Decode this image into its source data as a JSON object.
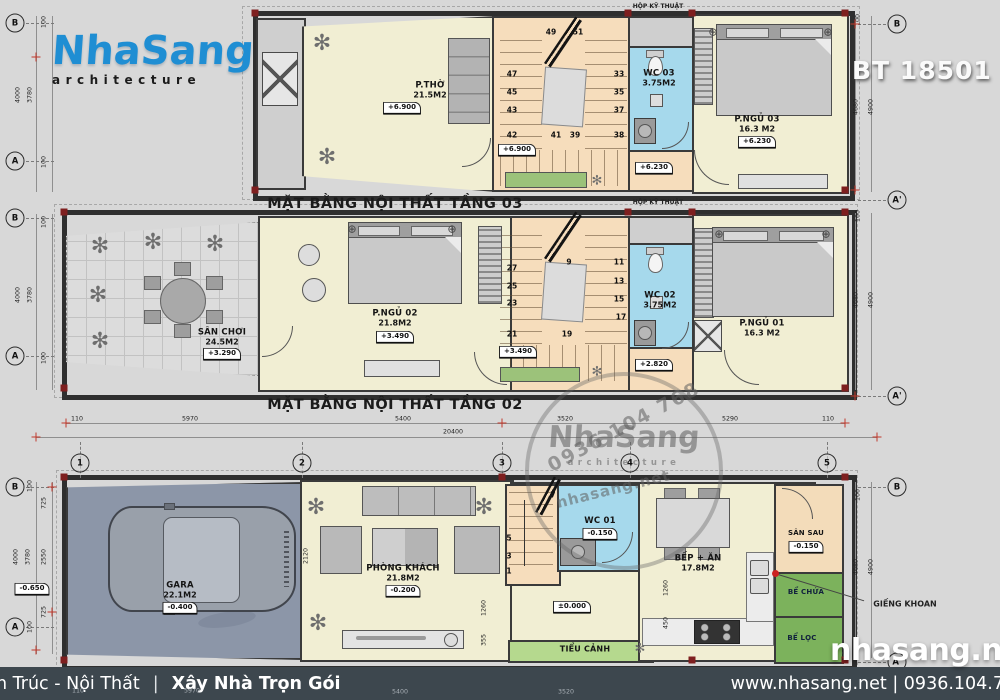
{
  "sheet": {
    "code": "BT 18501"
  },
  "logo": {
    "brand": "NhaSang",
    "sub": "architecture"
  },
  "footer": {
    "left": "n Trúc - Nội Thất",
    "sep": "|",
    "left_bold": "Xây Nhà Trọn Gói",
    "right": "www.nhasang.net | 0936.104.7"
  },
  "stamp": {
    "phone": "0936 104 768",
    "brand": "NhaSang",
    "sub": "architecture",
    "site": "nhasang.net"
  },
  "big_watermark": "nhasang.net",
  "colors": {
    "accent_blue": "#1f8ed3",
    "wall": "#3a3a3a",
    "wc_blue": "#a6d9ec",
    "room_cream": "#f1eed3",
    "stair_tan": "#f6ddbc",
    "tank_green": "#7cb25c",
    "garage_floor": "#8c96a8",
    "footer_bar": "#3d474e",
    "red_mark": "#c0392b"
  },
  "floor3": {
    "title": "MẶT BẰNG NỘI THẤT TẦNG 03",
    "duct": "HỘP KỸ THUẬT",
    "stair_level": "+6.900",
    "hall_level": "+6.230",
    "rooms": {
      "ptho": {
        "name": "P.THỜ",
        "area": "21.5M2",
        "level": "+6.900"
      },
      "wc": {
        "name": "WC 03",
        "area": "3.75M2"
      },
      "bed": {
        "name": "P.NGỦ 03",
        "area": "16.3 M2",
        "level": "+6.230"
      }
    }
  },
  "floor2": {
    "title": "MẶT BẰNG NỘI THẤT TẦNG 02",
    "duct": "HỘP KỸ THUẬT",
    "stair_level": "+3.490",
    "hall_level": "+2.820",
    "rooms": {
      "san_choi": {
        "name": "SÂN CHƠI",
        "area": "24.5M2",
        "level": "+3.290"
      },
      "bed2": {
        "name": "P.NGỦ 02",
        "area": "21.8M2",
        "level": "+3.490"
      },
      "wc": {
        "name": "WC 02",
        "area": "3.75M2"
      },
      "bed1": {
        "name": "P.NGỦ 01",
        "area": "16.3 M2"
      }
    }
  },
  "floor1": {
    "zero_level": "±0.000",
    "outside_level": "-0.650",
    "rooms": {
      "gara": {
        "name": "GARA",
        "area": "22.1M2",
        "level": "-0.400"
      },
      "khach": {
        "name": "PHÒNG KHÁCH",
        "area": "21.8M2",
        "level": "-0.200"
      },
      "wc": {
        "name": "WC 01",
        "level": "-0.150"
      },
      "bep": {
        "name": "BẾP + ĂN",
        "area": "17.8M2"
      },
      "san_sau": {
        "name": "SÂN SAU",
        "level": "-0.150"
      },
      "tieu_canh": {
        "name": "TIỂU CẢNH"
      },
      "be_chua": {
        "name": "BỂ CHỨA"
      },
      "be_loc": {
        "name": "BỂ LỌC"
      },
      "gieng": {
        "name": "GIẾNG KHOAN"
      }
    }
  },
  "icon_glyphs": {
    "plant": "✻",
    "lamp": "⊕"
  },
  "layers": {
    "lines": [
      {
        "c": "hline",
        "x": 66,
        "y": 423,
        "w": 779
      },
      {
        "c": "hline",
        "x": 36,
        "y": 437,
        "w": 841
      },
      {
        "c": "vline",
        "x": 36,
        "y": 16,
        "h": 176
      },
      {
        "c": "vline",
        "x": 52,
        "y": 16,
        "h": 176
      },
      {
        "c": "vline",
        "x": 36,
        "y": 214,
        "h": 176
      },
      {
        "c": "vline",
        "x": 52,
        "y": 214,
        "h": 176
      },
      {
        "c": "vline",
        "x": 36,
        "y": 482,
        "h": 172
      },
      {
        "c": "vline",
        "x": 52,
        "y": 482,
        "h": 172
      },
      {
        "c": "vline",
        "x": 855,
        "y": 16,
        "h": 176
      },
      {
        "c": "vline",
        "x": 871,
        "y": 16,
        "h": 176
      },
      {
        "c": "vline",
        "x": 855,
        "y": 213,
        "h": 177
      },
      {
        "c": "vline",
        "x": 871,
        "y": 213,
        "h": 177
      },
      {
        "c": "vline",
        "x": 855,
        "y": 482,
        "h": 176
      },
      {
        "c": "vline",
        "x": 871,
        "y": 482,
        "h": 176
      },
      {
        "c": "dashv",
        "x": 80,
        "y": 442,
        "h": 36
      },
      {
        "c": "dashv",
        "x": 302,
        "y": 442,
        "h": 36
      },
      {
        "c": "dashv",
        "x": 502,
        "y": 442,
        "h": 36
      },
      {
        "c": "dashv",
        "x": 630,
        "y": 442,
        "h": 36
      },
      {
        "c": "dashv",
        "x": 827,
        "y": 442,
        "h": 36
      },
      {
        "c": "dashh",
        "x": 26,
        "y": 23,
        "w": 28
      },
      {
        "c": "dashh",
        "x": 26,
        "y": 161,
        "w": 28
      },
      {
        "c": "dashh",
        "x": 26,
        "y": 218,
        "w": 28
      },
      {
        "c": "dashh",
        "x": 26,
        "y": 356,
        "w": 28
      },
      {
        "c": "dashh",
        "x": 26,
        "y": 487,
        "w": 28
      },
      {
        "c": "dashh",
        "x": 26,
        "y": 627,
        "w": 28
      },
      {
        "c": "dashh",
        "x": 858,
        "y": 24,
        "w": 28
      },
      {
        "c": "dashh",
        "x": 858,
        "y": 200,
        "w": 28
      },
      {
        "c": "dashh",
        "x": 858,
        "y": 396,
        "w": 28
      },
      {
        "c": "dashh",
        "x": 858,
        "y": 487,
        "w": 28
      },
      {
        "c": "dashh",
        "x": 858,
        "y": 662,
        "w": 28
      }
    ],
    "dims": [
      {
        "t": "110",
        "x": 77,
        "y": 419,
        "c": "dim"
      },
      {
        "t": "5970",
        "x": 190,
        "y": 419,
        "c": "dim"
      },
      {
        "t": "5400",
        "x": 403,
        "y": 419,
        "c": "dim"
      },
      {
        "t": "3520",
        "x": 565,
        "y": 419,
        "c": "dim"
      },
      {
        "t": "5290",
        "x": 730,
        "y": 419,
        "c": "dim"
      },
      {
        "t": "110",
        "x": 828,
        "y": 419,
        "c": "dim"
      },
      {
        "t": "20400",
        "x": 453,
        "y": 432,
        "c": "dim"
      },
      {
        "t": "4000",
        "x": 18,
        "y": 95,
        "r": -90,
        "c": "dim"
      },
      {
        "t": "3780",
        "x": 30,
        "y": 95,
        "r": -90,
        "c": "dim"
      },
      {
        "t": "100",
        "x": 44,
        "y": 22,
        "r": -90,
        "c": "dim"
      },
      {
        "t": "100",
        "x": 44,
        "y": 162,
        "r": -90,
        "c": "dim"
      },
      {
        "t": "4000",
        "x": 18,
        "y": 295,
        "r": -90,
        "c": "dim"
      },
      {
        "t": "3780",
        "x": 30,
        "y": 295,
        "r": -90,
        "c": "dim"
      },
      {
        "t": "100",
        "x": 44,
        "y": 222,
        "r": -90,
        "c": "dim"
      },
      {
        "t": "100",
        "x": 44,
        "y": 358,
        "r": -90,
        "c": "dim"
      },
      {
        "t": "100",
        "x": 30,
        "y": 486,
        "r": -90,
        "c": "dim"
      },
      {
        "t": "725",
        "x": 44,
        "y": 503,
        "r": -90,
        "c": "dim"
      },
      {
        "t": "4000",
        "x": 16,
        "y": 557,
        "r": -90,
        "c": "dim"
      },
      {
        "t": "3780",
        "x": 28,
        "y": 557,
        "r": -90,
        "c": "dim"
      },
      {
        "t": "2550",
        "x": 44,
        "y": 557,
        "r": -90,
        "c": "dim"
      },
      {
        "t": "725",
        "x": 44,
        "y": 612,
        "r": -90,
        "c": "dim"
      },
      {
        "t": "100",
        "x": 30,
        "y": 627,
        "r": -90,
        "c": "dim"
      },
      {
        "t": "100",
        "x": 858,
        "y": 20,
        "r": -90,
        "c": "dim"
      },
      {
        "t": "4680",
        "x": 856,
        "y": 107,
        "r": -90,
        "c": "dim"
      },
      {
        "t": "4900",
        "x": 871,
        "y": 107,
        "r": -90,
        "c": "dim"
      },
      {
        "t": "100",
        "x": 858,
        "y": 216,
        "r": -90,
        "c": "dim"
      },
      {
        "t": "4680",
        "x": 856,
        "y": 300,
        "r": -90,
        "c": "dim"
      },
      {
        "t": "4900",
        "x": 871,
        "y": 300,
        "r": -90,
        "c": "dim"
      },
      {
        "t": "100",
        "x": 858,
        "y": 495,
        "r": -90,
        "c": "dim"
      },
      {
        "t": "4680",
        "x": 856,
        "y": 567,
        "r": -90,
        "c": "dim"
      },
      {
        "t": "4900",
        "x": 871,
        "y": 567,
        "r": -90,
        "c": "dim"
      },
      {
        "t": "100",
        "x": 845,
        "y": 655,
        "r": -90,
        "c": "dim"
      },
      {
        "t": "2120",
        "x": 306,
        "y": 556,
        "r": -90,
        "c": "dim"
      },
      {
        "t": "1260",
        "x": 484,
        "y": 608,
        "r": -90,
        "c": "dim"
      },
      {
        "t": "355",
        "x": 484,
        "y": 640,
        "r": -90,
        "c": "dim"
      },
      {
        "t": "1260",
        "x": 666,
        "y": 588,
        "r": -90,
        "c": "dim"
      },
      {
        "t": "450",
        "x": 666,
        "y": 623,
        "r": -90,
        "c": "dim"
      },
      {
        "t": "110",
        "x": 78,
        "y": 691,
        "c": "faint"
      },
      {
        "t": "5970",
        "x": 192,
        "y": 691,
        "c": "faint"
      },
      {
        "t": "5400",
        "x": 400,
        "y": 692,
        "c": "faint"
      },
      {
        "t": "3520",
        "x": 566,
        "y": 692,
        "c": "faint"
      }
    ],
    "stairs": [
      {
        "t": "49",
        "x": 551,
        "y": 32,
        "c": "step"
      },
      {
        "t": "51",
        "x": 578,
        "y": 32,
        "c": "step"
      },
      {
        "t": "47",
        "x": 512,
        "y": 74,
        "c": "step"
      },
      {
        "t": "45",
        "x": 512,
        "y": 92,
        "c": "step"
      },
      {
        "t": "43",
        "x": 512,
        "y": 110,
        "c": "step"
      },
      {
        "t": "33",
        "x": 619,
        "y": 74,
        "c": "step"
      },
      {
        "t": "35",
        "x": 619,
        "y": 92,
        "c": "step"
      },
      {
        "t": "37",
        "x": 619,
        "y": 110,
        "c": "step"
      },
      {
        "t": "42",
        "x": 512,
        "y": 135,
        "c": "step"
      },
      {
        "t": "41",
        "x": 556,
        "y": 135,
        "c": "step"
      },
      {
        "t": "39",
        "x": 575,
        "y": 135,
        "c": "step"
      },
      {
        "t": "38",
        "x": 619,
        "y": 135,
        "c": "step"
      },
      {
        "t": "27",
        "x": 512,
        "y": 268,
        "c": "step"
      },
      {
        "t": "25",
        "x": 512,
        "y": 286,
        "c": "step"
      },
      {
        "t": "23",
        "x": 512,
        "y": 303,
        "c": "step"
      },
      {
        "t": "9",
        "x": 569,
        "y": 262,
        "c": "step"
      },
      {
        "t": "11",
        "x": 619,
        "y": 262,
        "c": "step"
      },
      {
        "t": "13",
        "x": 619,
        "y": 281,
        "c": "step"
      },
      {
        "t": "15",
        "x": 619,
        "y": 299,
        "c": "step"
      },
      {
        "t": "17",
        "x": 621,
        "y": 317,
        "c": "step"
      },
      {
        "t": "21",
        "x": 512,
        "y": 334,
        "c": "step"
      },
      {
        "t": "19",
        "x": 567,
        "y": 334,
        "c": "step"
      },
      {
        "t": "7",
        "x": 553,
        "y": 495,
        "c": "step"
      },
      {
        "t": "5",
        "x": 509,
        "y": 538,
        "c": "step"
      },
      {
        "t": "3",
        "x": 509,
        "y": 556,
        "c": "step"
      },
      {
        "t": "1",
        "x": 509,
        "y": 571,
        "c": "step"
      }
    ],
    "bubbles": [
      {
        "t": "B",
        "x": 15,
        "y": 23,
        "c": "bubble"
      },
      {
        "t": "A",
        "x": 15,
        "y": 161,
        "c": "bubble"
      },
      {
        "t": "B",
        "x": 15,
        "y": 218,
        "c": "bubble"
      },
      {
        "t": "A",
        "x": 15,
        "y": 356,
        "c": "bubble"
      },
      {
        "t": "B",
        "x": 15,
        "y": 487,
        "c": "bubble"
      },
      {
        "t": "A",
        "x": 15,
        "y": 627,
        "c": "bubble"
      },
      {
        "t": "B",
        "x": 897,
        "y": 24,
        "c": "bubble"
      },
      {
        "t": "A'",
        "x": 897,
        "y": 200,
        "c": "bubble"
      },
      {
        "t": "A'",
        "x": 897,
        "y": 396,
        "c": "bubble"
      },
      {
        "t": "B",
        "x": 897,
        "y": 487,
        "c": "bubble"
      },
      {
        "t": "A'",
        "x": 897,
        "y": 662,
        "c": "bubble"
      },
      {
        "t": "1",
        "x": 80,
        "y": 463,
        "c": "bubble"
      },
      {
        "t": "2",
        "x": 302,
        "y": 463,
        "c": "bubble"
      },
      {
        "t": "3",
        "x": 502,
        "y": 463,
        "c": "bubble"
      },
      {
        "t": "4",
        "x": 630,
        "y": 463,
        "c": "bubble"
      },
      {
        "t": "5",
        "x": 827,
        "y": 463,
        "c": "bubble"
      }
    ],
    "decor": [
      {
        "i": "plant",
        "x": 322,
        "y": 44,
        "c": "plant"
      },
      {
        "i": "plant",
        "x": 327,
        "y": 158,
        "c": "plant"
      },
      {
        "i": "plant",
        "x": 100,
        "y": 247,
        "c": "plant"
      },
      {
        "i": "plant",
        "x": 153,
        "y": 243,
        "c": "plant"
      },
      {
        "i": "plant",
        "x": 215,
        "y": 245,
        "c": "plant"
      },
      {
        "i": "plant",
        "x": 98,
        "y": 296,
        "c": "plant"
      },
      {
        "i": "plant",
        "x": 100,
        "y": 342,
        "c": "plant"
      },
      {
        "i": "plant",
        "x": 316,
        "y": 508,
        "c": "plant"
      },
      {
        "i": "plant",
        "x": 484,
        "y": 508,
        "c": "plant"
      },
      {
        "i": "plant",
        "x": 318,
        "y": 624,
        "c": "plant"
      },
      {
        "i": "plant",
        "x": 597,
        "y": 181,
        "c": "plant small"
      },
      {
        "i": "plant",
        "x": 597,
        "y": 372,
        "c": "plant small"
      },
      {
        "i": "plant",
        "x": 640,
        "y": 649,
        "c": "plant small"
      },
      {
        "i": "lamp",
        "x": 713,
        "y": 32,
        "c": "lamp"
      },
      {
        "i": "lamp",
        "x": 828,
        "y": 32,
        "c": "lamp"
      },
      {
        "i": "lamp",
        "x": 352,
        "y": 229,
        "c": "lamp"
      },
      {
        "i": "lamp",
        "x": 452,
        "y": 229,
        "c": "lamp"
      },
      {
        "i": "lamp",
        "x": 719,
        "y": 234,
        "c": "lamp"
      },
      {
        "i": "lamp",
        "x": 826,
        "y": 234,
        "c": "lamp"
      }
    ],
    "nodes": [
      {
        "x": 255,
        "y": 13,
        "c": "node"
      },
      {
        "x": 845,
        "y": 13,
        "c": "node"
      },
      {
        "x": 255,
        "y": 190,
        "c": "node"
      },
      {
        "x": 845,
        "y": 190,
        "c": "node"
      },
      {
        "x": 628,
        "y": 13,
        "c": "node"
      },
      {
        "x": 692,
        "y": 13,
        "c": "node"
      },
      {
        "x": 64,
        "y": 212,
        "c": "node"
      },
      {
        "x": 845,
        "y": 212,
        "c": "node"
      },
      {
        "x": 64,
        "y": 388,
        "c": "node"
      },
      {
        "x": 845,
        "y": 388,
        "c": "node"
      },
      {
        "x": 628,
        "y": 212,
        "c": "node"
      },
      {
        "x": 692,
        "y": 212,
        "c": "node"
      },
      {
        "x": 64,
        "y": 477,
        "c": "node"
      },
      {
        "x": 845,
        "y": 477,
        "c": "node"
      },
      {
        "x": 64,
        "y": 660,
        "c": "node"
      },
      {
        "x": 845,
        "y": 660,
        "c": "node"
      },
      {
        "x": 502,
        "y": 477,
        "c": "node"
      },
      {
        "x": 692,
        "y": 660,
        "c": "node"
      }
    ],
    "crosses": [
      {
        "x": 66,
        "y": 423,
        "c": "cross"
      },
      {
        "x": 845,
        "y": 423,
        "c": "cross"
      },
      {
        "x": 36,
        "y": 437,
        "c": "cross"
      },
      {
        "x": 877,
        "y": 437,
        "c": "cross"
      },
      {
        "x": 36,
        "y": 57,
        "c": "cross"
      },
      {
        "x": 855,
        "y": 24,
        "c": "cross"
      },
      {
        "x": 855,
        "y": 396,
        "c": "cross"
      },
      {
        "x": 52,
        "y": 487,
        "c": "cross"
      },
      {
        "x": 52,
        "y": 612,
        "c": "cross"
      },
      {
        "x": 36,
        "y": 650,
        "c": "cross"
      },
      {
        "x": 855,
        "y": 190,
        "c": "cross"
      },
      {
        "x": 502,
        "y": 423,
        "c": "cross"
      }
    ]
  }
}
